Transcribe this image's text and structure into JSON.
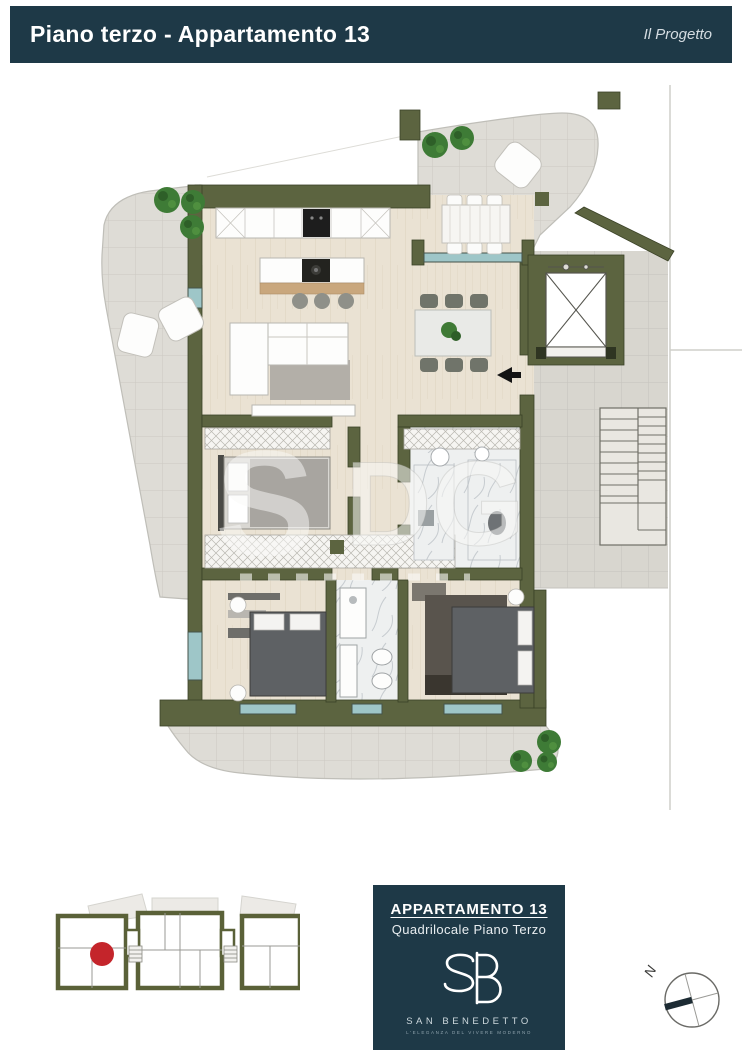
{
  "header": {
    "title": "Piano terzo - Appartamento 13",
    "right_label": "Il Progetto"
  },
  "plan": {
    "watermark_s": "S",
    "watermark_dg": "DG"
  },
  "footer": {
    "info_box": {
      "title": "APPARTAMENTO 13",
      "subtitle": "Quadrilocale Piano Terzo",
      "brand": "SAN BENEDETTO",
      "tagline": "l'eleganza del vivere moderno"
    },
    "compass_north": "N"
  },
  "colors": {
    "header_bg": "#1e3947",
    "wall_olive": "#5c6440",
    "terrace_tile": "#dedcd6",
    "wood_floor": "#eae2d3",
    "window_glass": "#9ec6c8",
    "tree_green": "#3e7b36",
    "location_red": "#c4252b"
  }
}
